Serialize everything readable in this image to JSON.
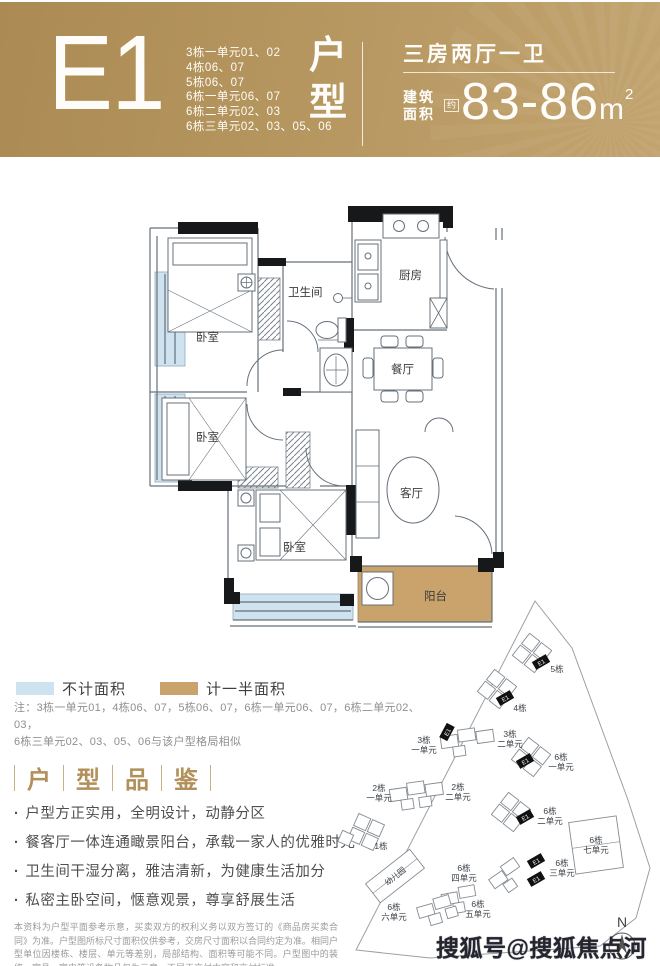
{
  "header": {
    "code": "E1",
    "units": [
      "3栋一单元01、02",
      "4栋06、07",
      "5栋06、07",
      "6栋一单元06、07",
      "6栋二单元02、03",
      "6栋三单元02、03、05、06"
    ],
    "category_chars": [
      "户",
      "型"
    ],
    "layout": "三房两厅一卫",
    "area_label_line1": "建筑",
    "area_label_line2": "面积",
    "area_about": "约",
    "area_value": "83-86",
    "area_unit": "m",
    "area_exp": "2"
  },
  "floor_plan": {
    "rooms": {
      "bedroom1": "卧室",
      "bedroom2": "卧室",
      "bedroom3": "卧室",
      "bathroom": "卫生间",
      "kitchen": "厨房",
      "dining": "餐厅",
      "living": "客厅",
      "balcony": "阳台"
    }
  },
  "legend": {
    "items": [
      {
        "label": "不计面积",
        "color": "#cfe2ef"
      },
      {
        "label": "计一半面积",
        "color": "#c9a36b"
      }
    ]
  },
  "note": {
    "line1": "注：3栋一单元01，4栋06、07，5栋06、07，6栋一单元06、07，6栋二单元02、03，",
    "line2": "6栋三单元02、03、05、06与该户型格局相似"
  },
  "review": {
    "title_chars": [
      "户",
      "型",
      "品",
      "鉴"
    ],
    "bullets": [
      "户型方正实用，全明设计，动静分区",
      "餐客厅一体连通瞰景阳台，承载一家人的优雅时光",
      "卫生间干湿分离，雅洁清新，为健康生活加分",
      "私密主卧空间，惬意观景，尊享舒展生活"
    ]
  },
  "disclaimer": "本资料为户型平面参考示意，买卖双方的权利义务以双方签订的《商品房买卖合同》为准。户型图所标尺寸面积仅供参考，交房尺寸面积以合同约定为准。相同户型单位因楼栋、楼层、单元等差别，局部结构、面积等可能不同。户型图中的装修、家具、家电等设备物品仅为示意，不属于交付内容和交付标准。",
  "site_plan": {
    "marker": "E1",
    "compass": "N",
    "kindergarten": "幼儿园",
    "labels": [
      {
        "l1": "5栋",
        "l2": ""
      },
      {
        "l1": "4栋",
        "l2": ""
      },
      {
        "l1": "3栋",
        "l2": "一单元"
      },
      {
        "l1": "3栋",
        "l2": "二单元"
      },
      {
        "l1": "6栋",
        "l2": "一单元"
      },
      {
        "l1": "2栋",
        "l2": "一单元"
      },
      {
        "l1": "2栋",
        "l2": "二单元"
      },
      {
        "l1": "1栋",
        "l2": ""
      },
      {
        "l1": "6栋",
        "l2": "二单元"
      },
      {
        "l1": "6栋",
        "l2": "七单元"
      },
      {
        "l1": "6栋",
        "l2": "四单元"
      },
      {
        "l1": "6栋",
        "l2": "三单元"
      },
      {
        "l1": "6栋",
        "l2": "六单元"
      },
      {
        "l1": "6栋",
        "l2": "五单元"
      }
    ]
  },
  "watermark": "搜狐号@搜狐焦点河池站"
}
